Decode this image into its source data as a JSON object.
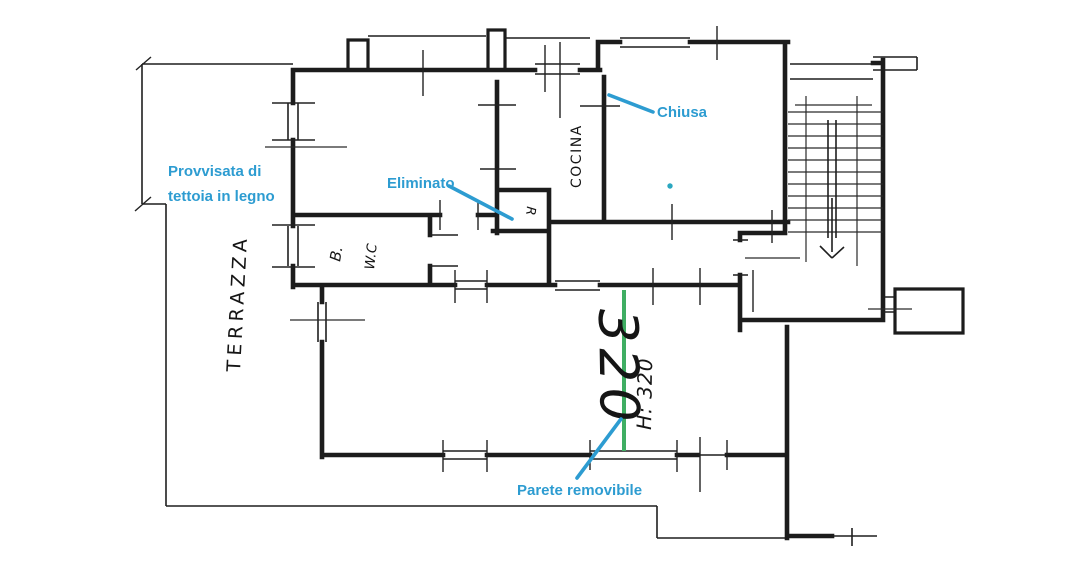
{
  "image_type": "hand-drawn apartment floor plan with renovation annotations",
  "colors": {
    "background": "#ffffff",
    "ink": "#1c1c1c",
    "annotation_blue": "#2d9cd1",
    "removable_wall_green": "#3fae63",
    "marker_dot_teal": "#2ba7c0"
  },
  "room_labels": {
    "terrace": "TERRAZZA",
    "kitchen": "COCINA",
    "bath": "B.",
    "wc": "W.C",
    "storage": "R"
  },
  "measurements": {
    "room_width": "320",
    "ceiling_height": "H: 320"
  },
  "annotations": {
    "canopy_line1": "Provvisata di",
    "canopy_line2": "tettoia in legno",
    "closed_door": "Chiusa",
    "removed_item": "Eliminato",
    "removable_wall": "Parete removibile"
  }
}
